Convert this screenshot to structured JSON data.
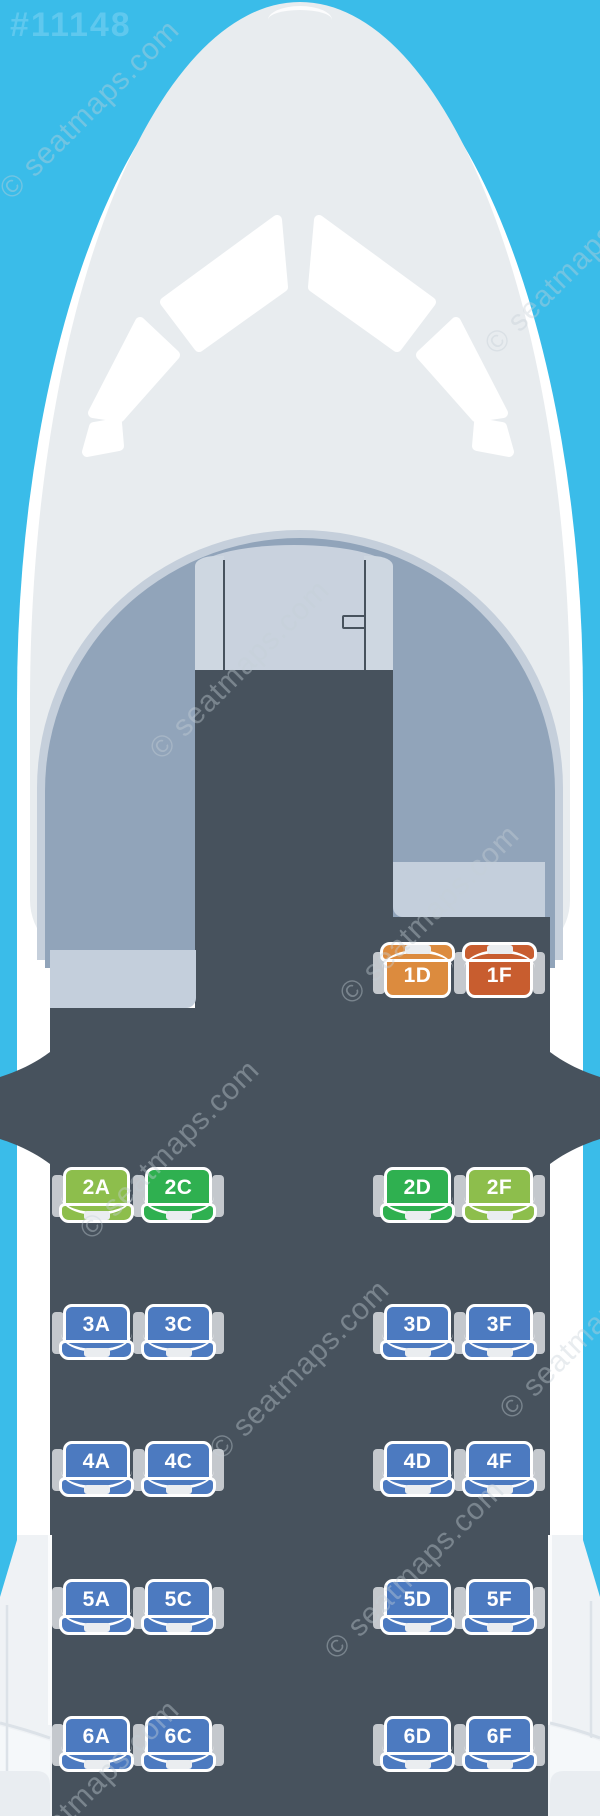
{
  "header": {
    "map_id": "#11148"
  },
  "watermark": {
    "text": "© seatmaps.com"
  },
  "cabin": {
    "seat_colors": {
      "blue": "#4C7AC0",
      "green": "#2FB050",
      "yellow_green": "#8DBE4C",
      "orange": "#DC8B3E",
      "deep_orange": "#C85D2F"
    },
    "columns": {
      "A": 63,
      "C": 145,
      "D": 384,
      "F": 466
    },
    "rows": [
      {
        "label": "1",
        "y": 944,
        "tab": "top",
        "sides": [
          "right"
        ],
        "seats": [
          {
            "id": "1D",
            "col": "D",
            "color": "orange"
          },
          {
            "id": "1F",
            "col": "F",
            "color": "deep_orange"
          }
        ]
      },
      {
        "label": "2",
        "y": 1167,
        "tab": "bottom",
        "sides": [
          "left",
          "right"
        ],
        "seats": [
          {
            "id": "2A",
            "col": "A",
            "color": "yellow_green"
          },
          {
            "id": "2C",
            "col": "C",
            "color": "green"
          },
          {
            "id": "2D",
            "col": "D",
            "color": "green"
          },
          {
            "id": "2F",
            "col": "F",
            "color": "yellow_green"
          }
        ]
      },
      {
        "label": "3",
        "y": 1304,
        "tab": "bottom",
        "sides": [
          "left",
          "right"
        ],
        "seats": [
          {
            "id": "3A",
            "col": "A",
            "color": "blue"
          },
          {
            "id": "3C",
            "col": "C",
            "color": "blue"
          },
          {
            "id": "3D",
            "col": "D",
            "color": "blue"
          },
          {
            "id": "3F",
            "col": "F",
            "color": "blue"
          }
        ]
      },
      {
        "label": "4",
        "y": 1441,
        "tab": "bottom",
        "sides": [
          "left",
          "right"
        ],
        "seats": [
          {
            "id": "4A",
            "col": "A",
            "color": "blue"
          },
          {
            "id": "4C",
            "col": "C",
            "color": "blue"
          },
          {
            "id": "4D",
            "col": "D",
            "color": "blue"
          },
          {
            "id": "4F",
            "col": "F",
            "color": "blue"
          }
        ]
      },
      {
        "label": "5",
        "y": 1579,
        "tab": "bottom",
        "sides": [
          "left",
          "right"
        ],
        "seats": [
          {
            "id": "5A",
            "col": "A",
            "color": "blue"
          },
          {
            "id": "5C",
            "col": "C",
            "color": "blue"
          },
          {
            "id": "5D",
            "col": "D",
            "color": "blue"
          },
          {
            "id": "5F",
            "col": "F",
            "color": "blue"
          }
        ]
      },
      {
        "label": "6",
        "y": 1716,
        "tab": "bottom",
        "sides": [
          "left",
          "right"
        ],
        "seats": [
          {
            "id": "6A",
            "col": "A",
            "color": "blue"
          },
          {
            "id": "6C",
            "col": "C",
            "color": "blue"
          },
          {
            "id": "6D",
            "col": "D",
            "color": "blue"
          },
          {
            "id": "6F",
            "col": "F",
            "color": "blue"
          }
        ]
      }
    ]
  }
}
